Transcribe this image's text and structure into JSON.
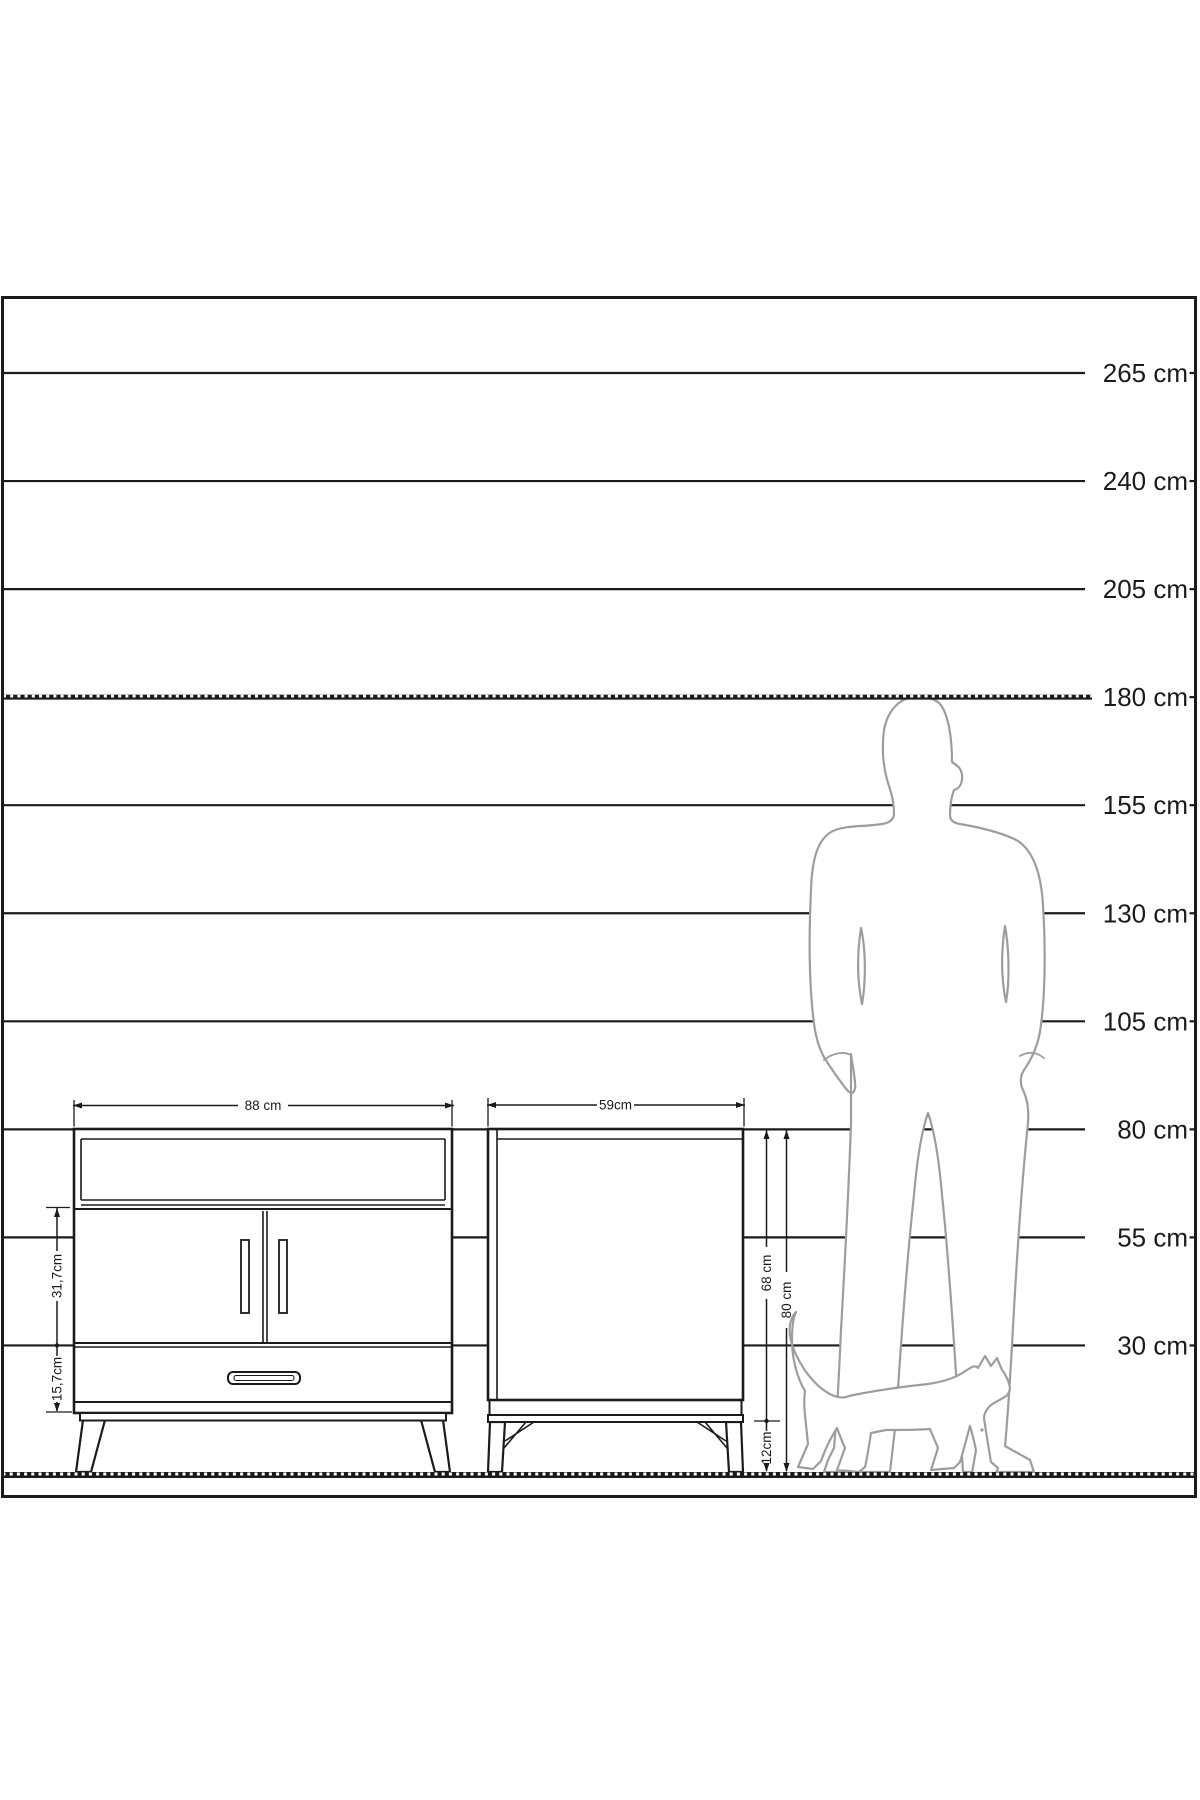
{
  "colors": {
    "ink": "#1b1b1b",
    "silhouette": "#9d9d9d",
    "background": "#ffffff"
  },
  "ruler": {
    "labels": [
      {
        "text": "265 cm",
        "dashed": false
      },
      {
        "text": "240 cm",
        "dashed": false
      },
      {
        "text": "205 cm",
        "dashed": false
      },
      {
        "text": "180 cm",
        "dashed": true
      },
      {
        "text": "155 cm",
        "dashed": false
      },
      {
        "text": "130 cm",
        "dashed": false
      },
      {
        "text": "105 cm",
        "dashed": false
      },
      {
        "text": "80 cm",
        "dashed": false
      },
      {
        "text": "55 cm",
        "dashed": false
      },
      {
        "text": "30 cm",
        "dashed": false
      }
    ]
  },
  "dimensions": {
    "sideboard_width": "88 cm",
    "nightstand_width": "59cm",
    "sideboard_door_section_height": "31,7cm",
    "sideboard_drawer_section_height": "15,7cm",
    "nightstand_body_height": "68 cm",
    "nightstand_total_height": "80 cm",
    "nightstand_leg_height": "12cm"
  }
}
